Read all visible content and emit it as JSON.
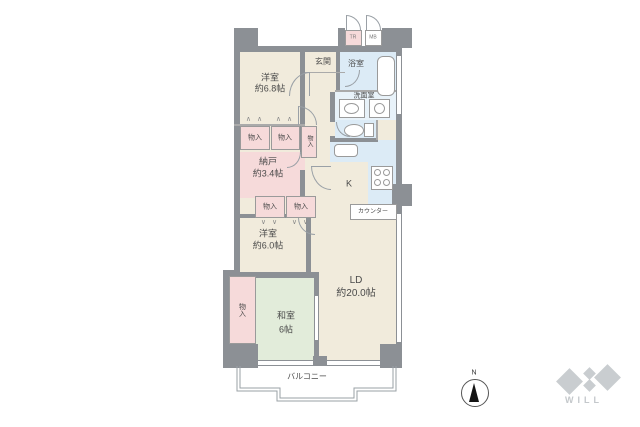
{
  "floorplan": {
    "rooms": {
      "western1_l1": "洋室",
      "western1_l2": "約6.8帖",
      "entrance": "玄関",
      "bath": "浴室",
      "washroom": "洗面室",
      "storage_room_l1": "納戸",
      "storage_room_l2": "約3.4帖",
      "kitchen": "K",
      "counter": "カウンター",
      "western2_l1": "洋室",
      "western2_l2": "約6.0帖",
      "japanese_l1": "和室",
      "japanese_l2": "6帖",
      "living_l1": "LD",
      "living_l2": "約20.0帖",
      "balcony": "バルコニー",
      "closet": "物入",
      "tr": "TR",
      "mb": "MB"
    },
    "icons": {
      "fold_up": "∧ ∧",
      "fold_down": "∨ ∨"
    },
    "compass": {
      "north": "N"
    },
    "logo": {
      "text": "WILL"
    },
    "colors": {
      "room_beige": "#f1ebdc",
      "closet_pink": "#f6dada",
      "wet_blue": "#dcebf6",
      "tatami_green": "#e2ecda",
      "wall_gray": "#8c9095",
      "logo_gray": "#c9cdd0"
    }
  }
}
